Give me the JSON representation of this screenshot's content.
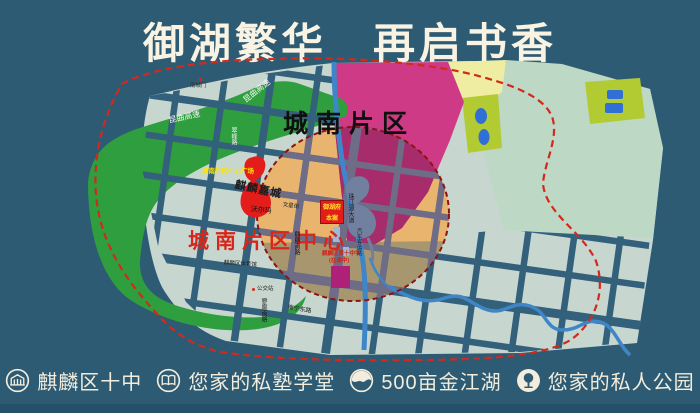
{
  "title": "御湖繁华　再启书香",
  "map": {
    "district_label": "城南片区",
    "center_label": "城南片区中心",
    "plaza_label": "城南片区中心广场",
    "complex_label": "麒麟嘉城",
    "walmart_label": "沃尔玛",
    "gym_label": "麒麟区体育馆",
    "gate_label": "南城门",
    "bus_label": "公交站",
    "station_label": "汽车客运站",
    "school_label_1": "麒麟区第十中学",
    "school_label_2": "(在建中)",
    "marker": {
      "line1": "御湖府",
      "line2": "本案"
    },
    "highway_label_1": "昆曲高速",
    "highway_label_2": "昆曲高速",
    "roads": {
      "r1": "翠峰路",
      "r2": "麒麟南路",
      "r3": "珠江源大道",
      "r4": "寥廓南路",
      "r5": "南宁东路",
      "r6": "文星街"
    }
  },
  "legend": {
    "items": [
      {
        "icon": "school-icon",
        "label": "麒麟区十中"
      },
      {
        "icon": "book-icon",
        "label": "您家的私塾学堂"
      },
      {
        "icon": "lake-icon",
        "label": "500亩金江湖"
      },
      {
        "icon": "tree-icon",
        "label": "您家的私人公园"
      }
    ]
  },
  "colors": {
    "background": "#2e5b74",
    "title_text": "#f8f3e2",
    "boundary_red": "#d3291c",
    "circle_red": "#8c1414",
    "plaza_red": "#e41d1b",
    "magenta_zone": "#cf3a86",
    "green_area": "#2f9e3f",
    "orange_core": "#e8b46e",
    "city_block": "#c7d7d0",
    "river_blue": "#3f86c8"
  }
}
